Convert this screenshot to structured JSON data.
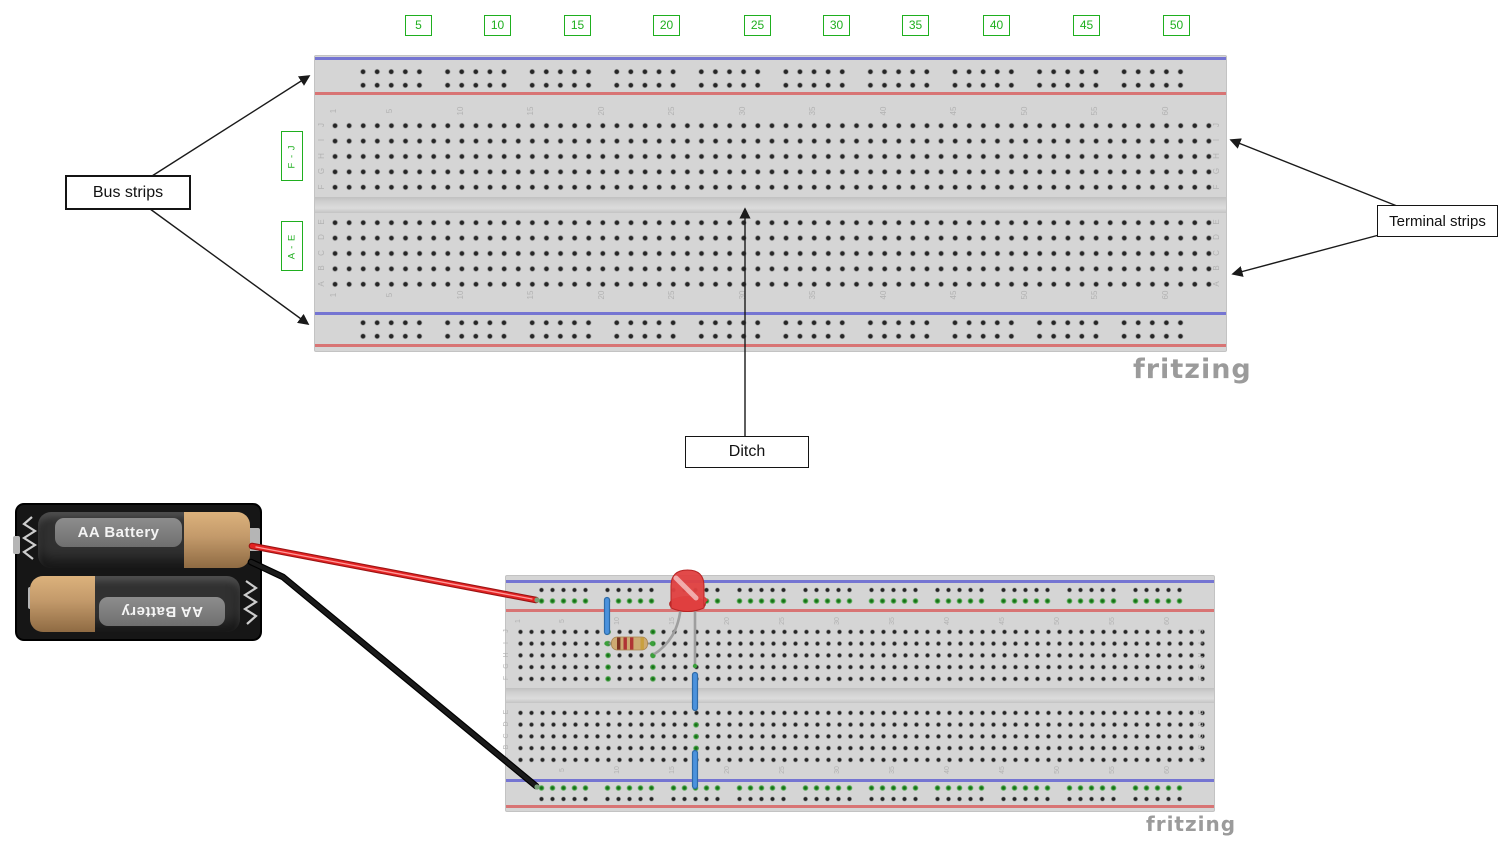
{
  "annotations": {
    "bus_strips": "Bus strips",
    "terminal_strips": "Terminal strips",
    "ditch": "Ditch",
    "row_group_top": "F - J",
    "row_group_bottom": "A - E",
    "column_markers": [
      "5",
      "10",
      "15",
      "20",
      "25",
      "30",
      "35",
      "40",
      "45",
      "50"
    ],
    "green_accent": "#1faf1f"
  },
  "boards": {
    "brand": "fritzing",
    "row_letters_top_section": [
      "J",
      "I",
      "H",
      "G",
      "F"
    ],
    "row_letters_bottom_section": [
      "E",
      "D",
      "C",
      "B",
      "A"
    ],
    "column_numbers": [
      "1",
      "5",
      "10",
      "15",
      "20",
      "25",
      "30",
      "35",
      "40",
      "45",
      "50",
      "55",
      "60"
    ]
  },
  "battery": {
    "cell_top_label": "AA Battery",
    "cell_bottom_label": "AA Battery"
  },
  "components": {
    "red_wire_color": "#e32222",
    "black_wire_color": "#1a1a1a",
    "jumper_color": "#4b92dd",
    "led_color": "#e04040",
    "resistor_body_color": "#cdaa72",
    "highlight_dot_color": "#3aa03a"
  }
}
